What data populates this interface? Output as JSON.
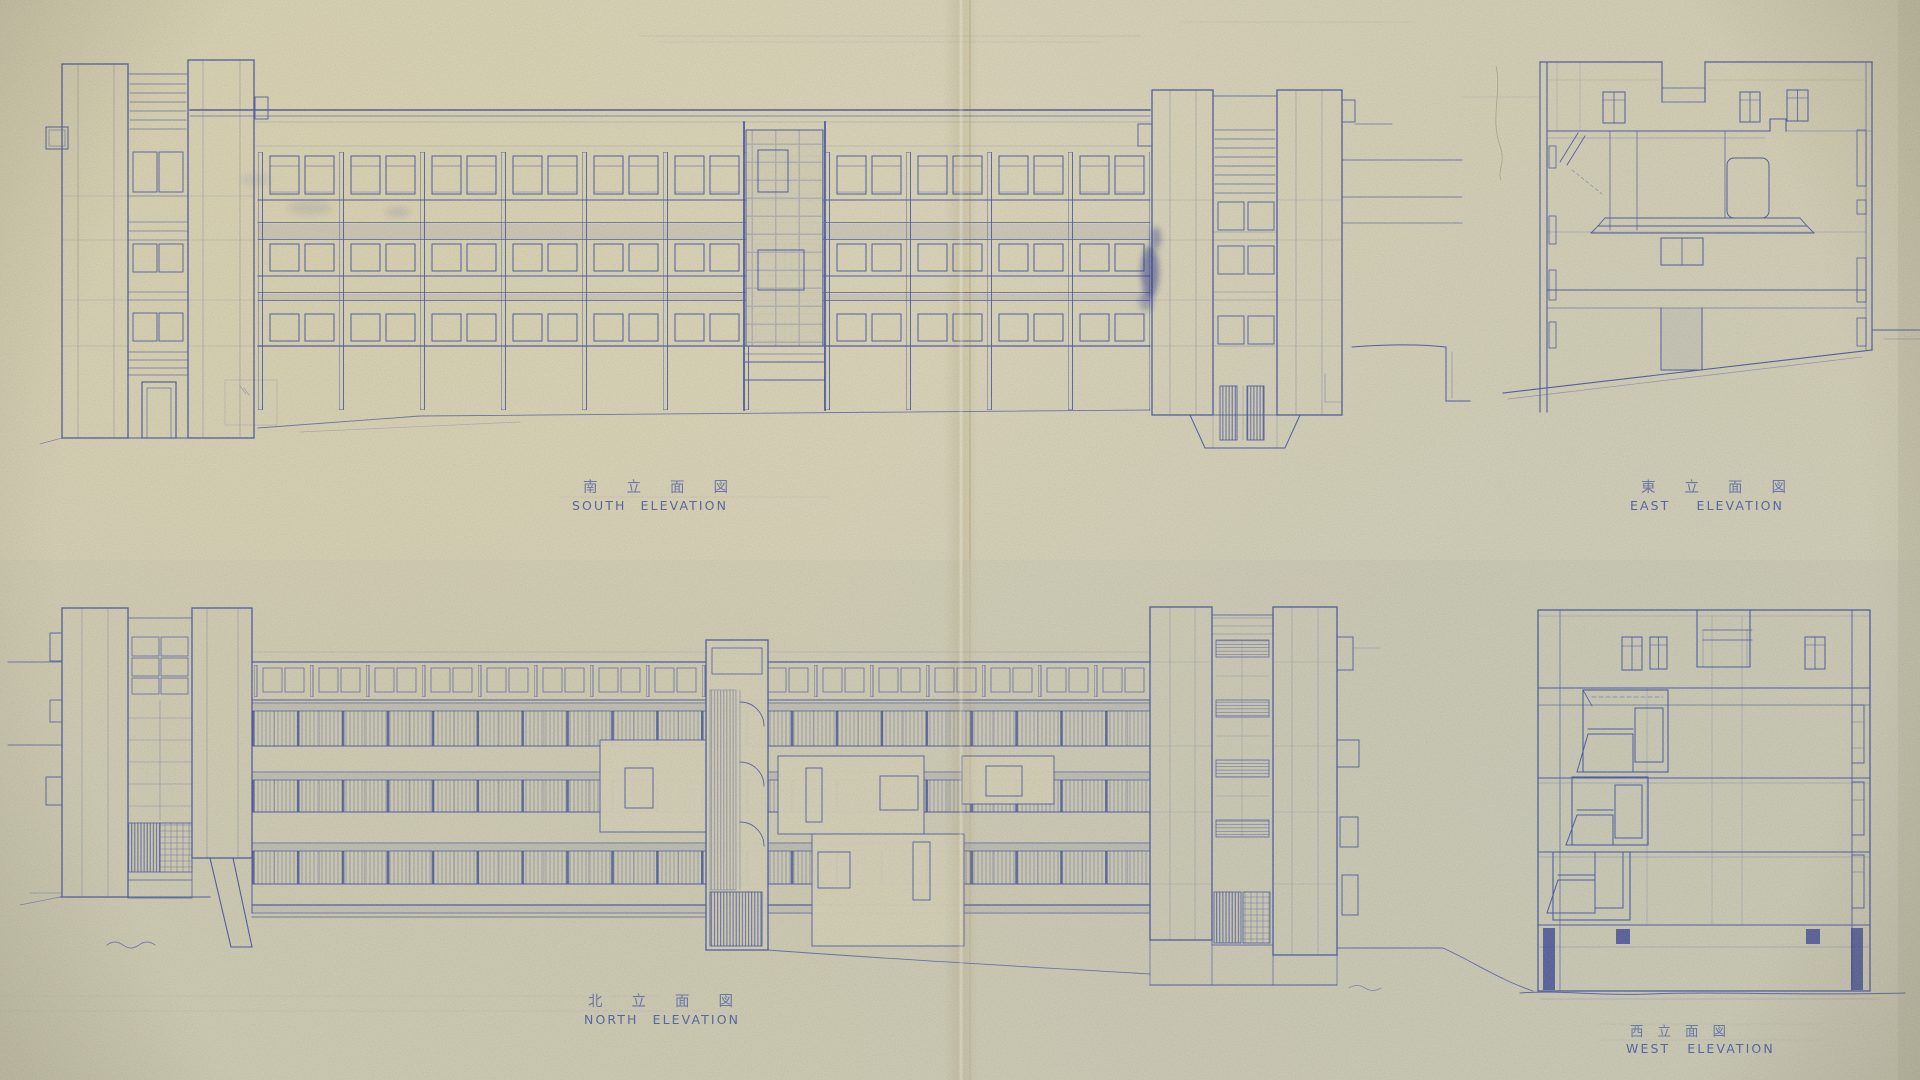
{
  "sheet": {
    "kind": "architectural elevation blueprint",
    "colors": {
      "paper": "#d4d0b7",
      "ink": "#4a58a3",
      "ink_dark": "#33418f",
      "crease": "#b8945a"
    }
  },
  "elevations": {
    "south": {
      "label_ja": "南立面図",
      "label_en": "SOUTH ELEVATION"
    },
    "east": {
      "label_ja": "東立面図",
      "label_en": "EAST ELEVATION"
    },
    "north": {
      "label_ja": "北立面図",
      "label_en": "NORTH ELEVATION"
    },
    "west": {
      "label_ja": "西立面図",
      "label_en": "WEST ELEVATION"
    }
  }
}
